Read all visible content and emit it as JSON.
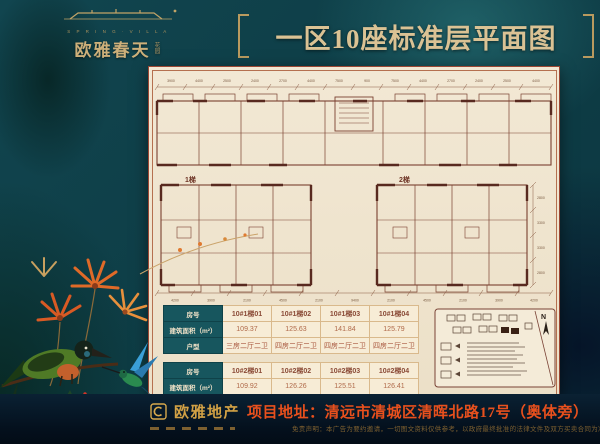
{
  "brand": {
    "name_en": "S P R I N G · V I L L A",
    "name_cn": "欧雅春天",
    "name_suffix": "花园"
  },
  "title": "一区10座标准层平面图",
  "plan": {
    "label_left": "1梯",
    "label_right": "2梯",
    "dims_top": [
      "3900",
      "4400",
      "2500",
      "2400",
      "2700",
      "4400",
      "7500",
      "900",
      "7500",
      "4400",
      "2700",
      "2400",
      "2500",
      "4400"
    ],
    "dims_bottom": [
      "4200",
      "3900",
      "2100",
      "4500",
      "2100",
      "9400",
      "2100",
      "4500",
      "2100",
      "3900",
      "4200"
    ],
    "dims_right": [
      "2800",
      "3300",
      "3300",
      "2800"
    ]
  },
  "unit_tables": [
    {
      "row_headers": {
        "no": "房号",
        "area": "建筑面积（m²）",
        "type": "户型"
      },
      "units": [
        {
          "no": "10#1梯01",
          "area": "109.37",
          "type": "三房二厅二卫"
        },
        {
          "no": "10#1梯02",
          "area": "125.63",
          "type": "四房二厅二卫"
        },
        {
          "no": "10#1梯03",
          "area": "141.84",
          "type": "四房二厅二卫"
        },
        {
          "no": "10#1梯04",
          "area": "125.79",
          "type": "四房二厅二卫"
        }
      ]
    },
    {
      "row_headers": {
        "no": "房号",
        "area": "建筑面积（m²）",
        "type": "户型"
      },
      "units": [
        {
          "no": "10#2梯01",
          "area": "109.92",
          "type": "三房二厅二卫"
        },
        {
          "no": "10#2梯02",
          "area": "126.26",
          "type": "四房二厅二卫"
        },
        {
          "no": "10#2梯03",
          "area": "125.51",
          "type": "四房二厅二卫"
        },
        {
          "no": "10#2梯04",
          "area": "126.41",
          "type": "四房二厅二卫"
        }
      ]
    }
  ],
  "site_map": {
    "north_label": "N"
  },
  "footer": {
    "developer": "欧雅地产",
    "address_label": "项目地址：",
    "address": "清远市清城区清晖北路17号（奥体旁）",
    "disclaimer": "免责声明：本广告为要约邀请，一切图文资料仅供参考，以政府最终批准的法律文件及双方买卖合同为准。"
  },
  "colors": {
    "background_teal": "#0e3e47",
    "paper": "#f0e6d2",
    "frame_red": "#9c4733",
    "table_header_teal": "#17565e",
    "brand_gold": "#cdb07a",
    "address_orange": "#e8501d",
    "plan_line_brown": "#7a4030"
  }
}
